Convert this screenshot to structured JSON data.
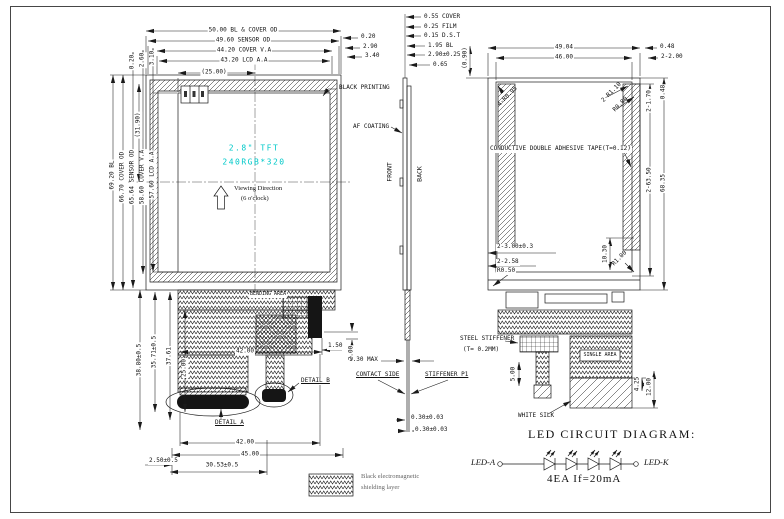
{
  "front_view": {
    "dims_top": [
      "50.00 BL & COVER OD",
      "49.60 SENSOR OD",
      "44.20 COVER V.A",
      "43.20 LCD A.A",
      "(25.00)"
    ],
    "dims_top_right": [
      "0.20",
      "2.90",
      "3.40"
    ],
    "dims_left_small": [
      "0.20",
      "2.60",
      "3.10"
    ],
    "dims_left": [
      "69.20 BL",
      "66.70 COVER OD",
      "65.64 SENSOR OD",
      "58.60 COVER V.A",
      "57.60 LCD A.A",
      "(31.90)"
    ],
    "black_printing": "BLACK PRINTING",
    "lcd": {
      "size": "2.8\" TFT",
      "resolution": "240RGB*320"
    },
    "viewing_line1": "Viewing Direction",
    "viewing_line2": "(6 o'clock)"
  },
  "fpc_front": {
    "bending_area": "BENDING AREA",
    "dims_left": [
      "38.80±0.5",
      "35.71±0.5",
      "37.61",
      "25.00"
    ],
    "dim_width_inner": "42.00",
    "dims_right": [
      "1.50",
      "2.00"
    ],
    "detail_b": "DETAIL B",
    "detail_a": "DETAIL A",
    "dims_bottom": [
      "42.00",
      "45.00",
      "2.50±0.5",
      "30.53±0.5"
    ]
  },
  "section_view": {
    "dims_top": [
      "0.55 COVER",
      "0.25 FILM",
      "0.15 D.S.T",
      "1.95 BL",
      "2.90±0.25",
      "0.65"
    ],
    "af_coating": "AF COATING",
    "front": "FRONT",
    "back": "BACK",
    "dim_max": "1.30 MAX",
    "contact_side": "CONTACT SIDE",
    "stiffener": "STIFFENER P1",
    "dim_thickness_1": "0.30±0.03",
    "dim_thickness_2": "0.30±0.03"
  },
  "back_view": {
    "dims_top": [
      "49.04",
      "46.00"
    ],
    "dims_top_right": [
      "0.48",
      "2-2.00"
    ],
    "dim_left_rot": "(0.90)",
    "radius_tl": "4-R0.95",
    "radius_tr_1": "2-R1.10",
    "radius_tr_2": "R0.80",
    "tape": "CONDUCTIVE DOUBLE ADHESIVE TAPE(T=0.12)",
    "dims_right_rot": [
      "2-1.70",
      "0.48",
      "2-63.50",
      "68.35"
    ],
    "dims_bottom": [
      "2-3.00±0.3",
      "2-2.58",
      "R0.50"
    ],
    "dim_bot_rot": "10.30",
    "radius_bot": "R1.00"
  },
  "fpc_back": {
    "steel_stiffener_1": "STEEL STIFFENER",
    "steel_stiffener_2": "(T= 0.2MM)",
    "single_area": "SINGLE AREA",
    "white_silk": "WHITE SILK",
    "dims": [
      "5.00",
      "4.25",
      "12.00"
    ]
  },
  "led_circuit": {
    "title": "LED CIRCUIT DIAGRAM:",
    "left_terminal": "LED-A",
    "right_terminal": "LED-K",
    "note": "4EA  If=20mA"
  },
  "legend": {
    "line1": "Black electromagnetic",
    "line2": "shielding layer"
  },
  "colors": {
    "line": "#1a1a1a",
    "lcd_text": "#00c9c9"
  }
}
